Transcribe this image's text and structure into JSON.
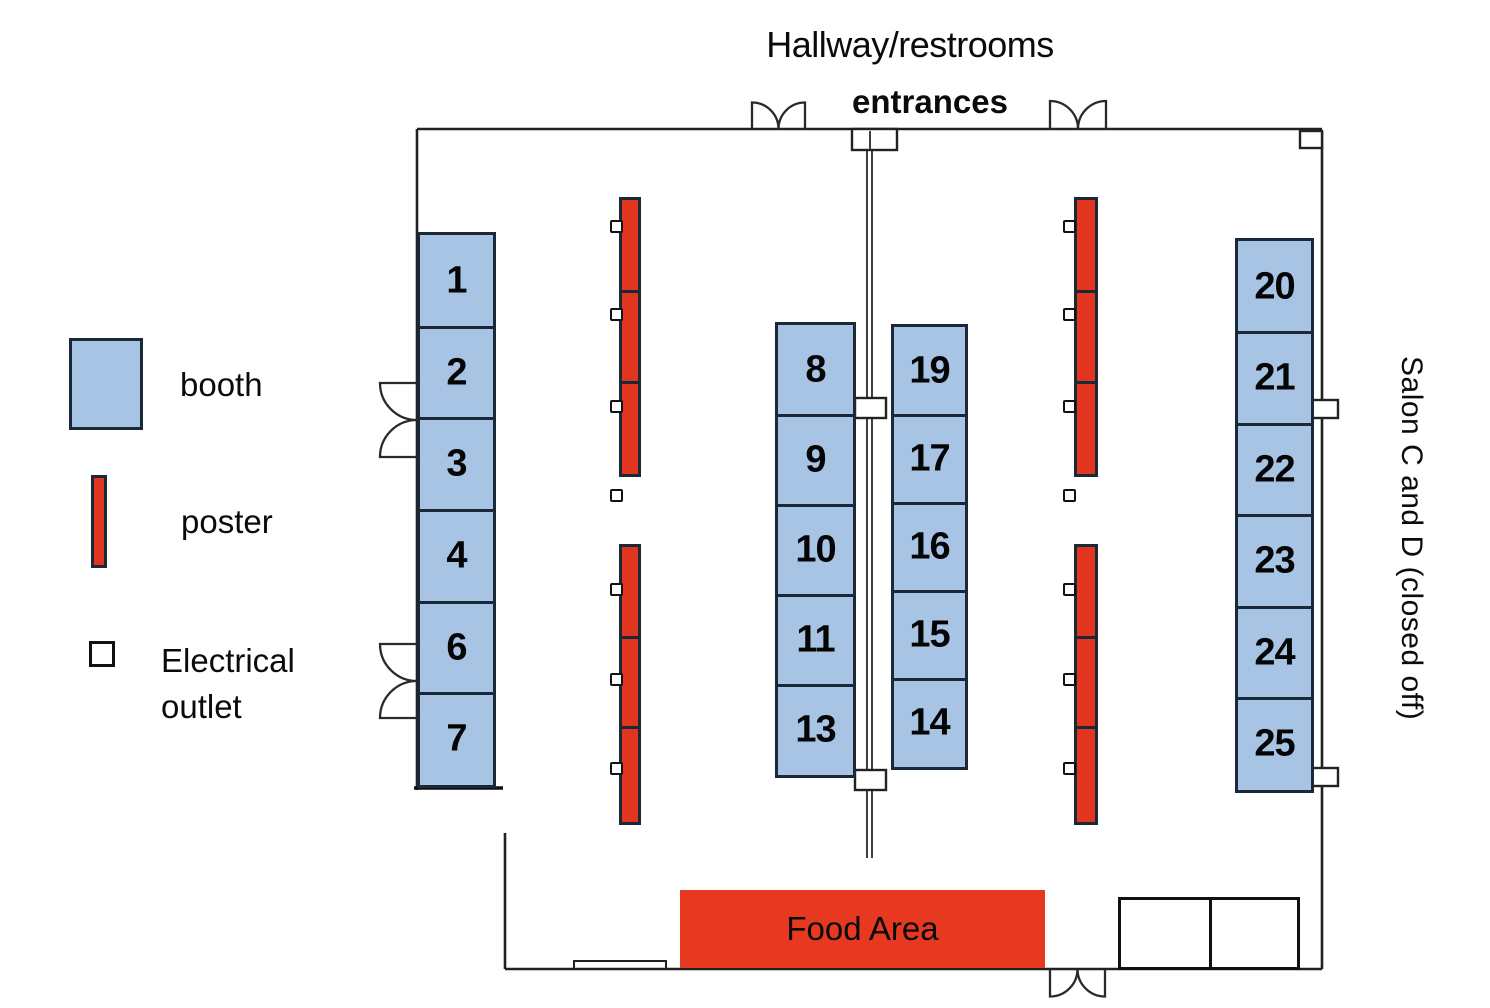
{
  "header": {
    "hallway": "Hallway/restrooms",
    "entrances": "entrances"
  },
  "side_label": "Salon C and D (closed off)",
  "food_area": {
    "label": "Food Area"
  },
  "legend": {
    "booth": "booth",
    "poster": "poster",
    "outlet_line1": "Electrical",
    "outlet_line2": "outlet"
  },
  "booth_columns": [
    {
      "id": "left",
      "booths": [
        "1",
        "2",
        "3",
        "4",
        "6",
        "7"
      ]
    },
    {
      "id": "center-left",
      "booths": [
        "8",
        "9",
        "10",
        "11",
        "13"
      ]
    },
    {
      "id": "center-right",
      "booths": [
        "19",
        "17",
        "16",
        "15",
        "14"
      ]
    },
    {
      "id": "right",
      "booths": [
        "20",
        "21",
        "22",
        "23",
        "24",
        "25"
      ]
    }
  ],
  "colors": {
    "booth_fill": "#a7c4e5",
    "booth_border": "#1b2838",
    "poster_red": "#e23520",
    "food_red": "#e6391f",
    "wall": "#212121"
  }
}
